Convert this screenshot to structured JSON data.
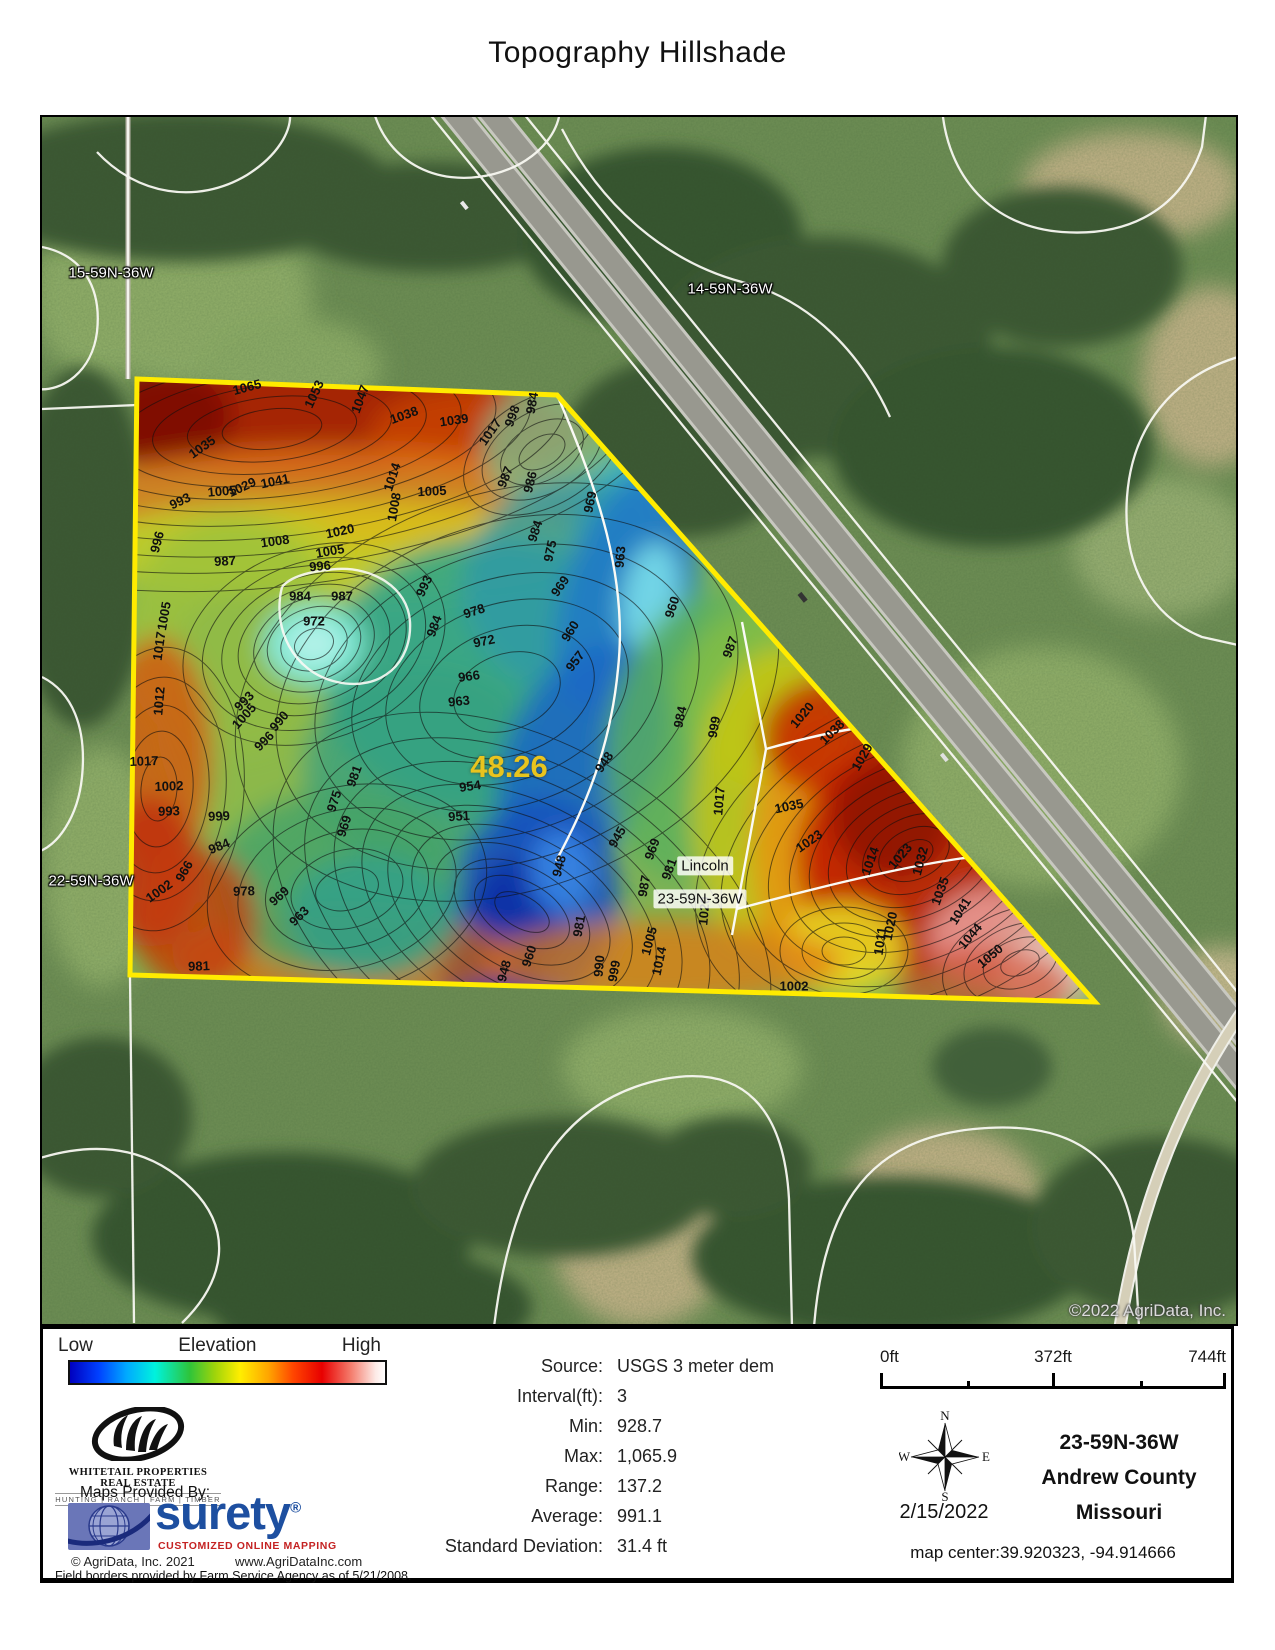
{
  "page": {
    "title": "Topography Hillshade"
  },
  "map": {
    "watermark": "©2022 AgriData, Inc.",
    "acreage_label": "48.26",
    "acreage_pos": {
      "x": 467,
      "y": 650
    },
    "parcel_labels": [
      {
        "text": "15-59N-36W",
        "x": 69,
        "y": 156,
        "variant": "light"
      },
      {
        "text": "14-59N-36W",
        "x": 688,
        "y": 172,
        "variant": "light"
      },
      {
        "text": "22-59N-36W",
        "x": 49,
        "y": 764,
        "variant": "light"
      },
      {
        "text": "Lincoln",
        "x": 663,
        "y": 749,
        "variant": "dark"
      },
      {
        "text": "23-59N-36W",
        "x": 658,
        "y": 782,
        "variant": "dark"
      }
    ],
    "contour_labels": [
      {
        "v": "1065",
        "x": 205,
        "y": 270,
        "r": -15
      },
      {
        "v": "1053",
        "x": 272,
        "y": 277,
        "r": -65
      },
      {
        "v": "1047",
        "x": 318,
        "y": 282,
        "r": -70
      },
      {
        "v": "1038",
        "x": 362,
        "y": 298,
        "r": -20
      },
      {
        "v": "1039",
        "x": 412,
        "y": 303,
        "r": -8
      },
      {
        "v": "1017",
        "x": 448,
        "y": 315,
        "r": -55
      },
      {
        "v": "998",
        "x": 470,
        "y": 299,
        "r": -70
      },
      {
        "v": "984",
        "x": 490,
        "y": 286,
        "r": -80
      },
      {
        "v": "1035",
        "x": 160,
        "y": 330,
        "r": -35
      },
      {
        "v": "1029",
        "x": 200,
        "y": 370,
        "r": -25
      },
      {
        "v": "1041",
        "x": 233,
        "y": 364,
        "r": -12
      },
      {
        "v": "1005",
        "x": 180,
        "y": 374,
        "r": -5
      },
      {
        "v": "1014",
        "x": 350,
        "y": 360,
        "r": -72
      },
      {
        "v": "1008",
        "x": 352,
        "y": 390,
        "r": -80
      },
      {
        "v": "1005",
        "x": 390,
        "y": 374,
        "r": -3
      },
      {
        "v": "987",
        "x": 463,
        "y": 360,
        "r": -68
      },
      {
        "v": "986",
        "x": 488,
        "y": 365,
        "r": -76
      },
      {
        "v": "969",
        "x": 548,
        "y": 385,
        "r": -78
      },
      {
        "v": "963",
        "x": 578,
        "y": 440,
        "r": -85
      },
      {
        "v": "993",
        "x": 138,
        "y": 384,
        "r": -25
      },
      {
        "v": "996",
        "x": 115,
        "y": 425,
        "r": -75
      },
      {
        "v": "987",
        "x": 183,
        "y": 444,
        "r": -3
      },
      {
        "v": "1020",
        "x": 298,
        "y": 414,
        "r": -12
      },
      {
        "v": "1008",
        "x": 233,
        "y": 424,
        "r": -8
      },
      {
        "v": "1005",
        "x": 288,
        "y": 434,
        "r": -10
      },
      {
        "v": "996",
        "x": 278,
        "y": 449,
        "r": -5
      },
      {
        "v": "984",
        "x": 493,
        "y": 414,
        "r": -72
      },
      {
        "v": "975",
        "x": 508,
        "y": 434,
        "r": -78
      },
      {
        "v": "969",
        "x": 518,
        "y": 469,
        "r": -55
      },
      {
        "v": "960",
        "x": 528,
        "y": 514,
        "r": -58
      },
      {
        "v": "957",
        "x": 533,
        "y": 544,
        "r": -52
      },
      {
        "v": "984",
        "x": 258,
        "y": 479,
        "r": 0
      },
      {
        "v": "987",
        "x": 300,
        "y": 479,
        "r": 0
      },
      {
        "v": "972",
        "x": 272,
        "y": 504,
        "r": 0
      },
      {
        "v": "1005",
        "x": 122,
        "y": 499,
        "r": -80
      },
      {
        "v": "1017",
        "x": 117,
        "y": 529,
        "r": -82
      },
      {
        "v": "1012",
        "x": 117,
        "y": 584,
        "r": -85
      },
      {
        "v": "978",
        "x": 432,
        "y": 494,
        "r": -18
      },
      {
        "v": "972",
        "x": 442,
        "y": 524,
        "r": -12
      },
      {
        "v": "966",
        "x": 427,
        "y": 559,
        "r": -8
      },
      {
        "v": "963",
        "x": 417,
        "y": 584,
        "r": -6
      },
      {
        "v": "984",
        "x": 392,
        "y": 509,
        "r": -70
      },
      {
        "v": "993",
        "x": 382,
        "y": 469,
        "r": -65
      },
      {
        "v": "954",
        "x": 428,
        "y": 669,
        "r": -8
      },
      {
        "v": "951",
        "x": 417,
        "y": 699,
        "r": -4
      },
      {
        "v": "948",
        "x": 517,
        "y": 749,
        "r": -75
      },
      {
        "v": "945",
        "x": 575,
        "y": 720,
        "r": -60
      },
      {
        "v": "969",
        "x": 610,
        "y": 732,
        "r": -70
      },
      {
        "v": "981",
        "x": 627,
        "y": 752,
        "r": -70
      },
      {
        "v": "1017",
        "x": 677,
        "y": 684,
        "r": -85
      },
      {
        "v": "1035",
        "x": 747,
        "y": 689,
        "r": -12
      },
      {
        "v": "1023",
        "x": 767,
        "y": 724,
        "r": -35
      },
      {
        "v": "1020",
        "x": 760,
        "y": 598,
        "r": -50
      },
      {
        "v": "1038",
        "x": 790,
        "y": 615,
        "r": -45
      },
      {
        "v": "1029",
        "x": 820,
        "y": 640,
        "r": -60
      },
      {
        "v": "987",
        "x": 688,
        "y": 530,
        "r": -70
      },
      {
        "v": "999",
        "x": 672,
        "y": 610,
        "r": -80
      },
      {
        "v": "984",
        "x": 638,
        "y": 600,
        "r": -78
      },
      {
        "v": "960",
        "x": 630,
        "y": 490,
        "r": -72
      },
      {
        "v": "948",
        "x": 562,
        "y": 645,
        "r": -55
      },
      {
        "v": "1014",
        "x": 828,
        "y": 744,
        "r": -70
      },
      {
        "v": "1023",
        "x": 858,
        "y": 739,
        "r": -50
      },
      {
        "v": "1032",
        "x": 878,
        "y": 744,
        "r": -75
      },
      {
        "v": "1035",
        "x": 898,
        "y": 774,
        "r": -70
      },
      {
        "v": "1041",
        "x": 918,
        "y": 794,
        "r": -58
      },
      {
        "v": "1044",
        "x": 928,
        "y": 819,
        "r": -50
      },
      {
        "v": "1050",
        "x": 948,
        "y": 839,
        "r": -40
      },
      {
        "v": "1020",
        "x": 848,
        "y": 809,
        "r": -78
      },
      {
        "v": "1011",
        "x": 838,
        "y": 824,
        "r": -82
      },
      {
        "v": "1002",
        "x": 752,
        "y": 869,
        "r": 0
      },
      {
        "v": "1020",
        "x": 662,
        "y": 794,
        "r": -85
      },
      {
        "v": "1005",
        "x": 607,
        "y": 824,
        "r": -75
      },
      {
        "v": "1014",
        "x": 617,
        "y": 844,
        "r": -78
      },
      {
        "v": "999",
        "x": 572,
        "y": 854,
        "r": -80
      },
      {
        "v": "990",
        "x": 557,
        "y": 849,
        "r": -85
      },
      {
        "v": "987",
        "x": 602,
        "y": 769,
        "r": -80
      },
      {
        "v": "981",
        "x": 537,
        "y": 809,
        "r": -80
      },
      {
        "v": "960",
        "x": 487,
        "y": 839,
        "r": -72
      },
      {
        "v": "948",
        "x": 462,
        "y": 854,
        "r": -75
      },
      {
        "v": "978",
        "x": 202,
        "y": 774,
        "r": -2
      },
      {
        "v": "969",
        "x": 237,
        "y": 779,
        "r": -42
      },
      {
        "v": "963",
        "x": 257,
        "y": 799,
        "r": -45
      },
      {
        "v": "984",
        "x": 177,
        "y": 729,
        "r": -22
      },
      {
        "v": "999",
        "x": 177,
        "y": 699,
        "r": -2
      },
      {
        "v": "993",
        "x": 127,
        "y": 694,
        "r": -2
      },
      {
        "v": "1002",
        "x": 127,
        "y": 669,
        "r": -2
      },
      {
        "v": "1017",
        "x": 102,
        "y": 644,
        "r": -2
      },
      {
        "v": "966",
        "x": 142,
        "y": 754,
        "r": -60
      },
      {
        "v": "1002",
        "x": 117,
        "y": 774,
        "r": -35
      },
      {
        "v": "981",
        "x": 157,
        "y": 849,
        "r": -2
      },
      {
        "v": "993",
        "x": 202,
        "y": 584,
        "r": -45
      },
      {
        "v": "990",
        "x": 237,
        "y": 604,
        "r": -50
      },
      {
        "v": "996",
        "x": 222,
        "y": 624,
        "r": -45
      },
      {
        "v": "1005",
        "x": 202,
        "y": 599,
        "r": -48
      },
      {
        "v": "981",
        "x": 312,
        "y": 659,
        "r": -70
      },
      {
        "v": "975",
        "x": 292,
        "y": 684,
        "r": -72
      },
      {
        "v": "969",
        "x": 302,
        "y": 709,
        "r": -72
      }
    ],
    "colors": {
      "parcel_outline": "#ffeb00",
      "acreage_text": "#e9c41e"
    }
  },
  "legend": {
    "low": "Low",
    "title": "Elevation",
    "high": "High",
    "gradient_stops": [
      {
        "color": "#0000bf",
        "pos": "0%"
      },
      {
        "color": "#0040ff",
        "pos": "9%"
      },
      {
        "color": "#00aaff",
        "pos": "18%"
      },
      {
        "color": "#00f2dd",
        "pos": "27%"
      },
      {
        "color": "#2ec43a",
        "pos": "38%"
      },
      {
        "color": "#9fd40a",
        "pos": "46%"
      },
      {
        "color": "#ffee00",
        "pos": "54%"
      },
      {
        "color": "#ffa500",
        "pos": "63%"
      },
      {
        "color": "#ff4400",
        "pos": "71%"
      },
      {
        "color": "#e80000",
        "pos": "80%"
      },
      {
        "color": "#f47a6a",
        "pos": "89%"
      },
      {
        "color": "#fdeae6",
        "pos": "97%"
      },
      {
        "color": "#ffffff",
        "pos": "100%"
      }
    ]
  },
  "stats": {
    "rows": [
      {
        "label": "Source:",
        "value": "USGS 3 meter dem"
      },
      {
        "label": "Interval(ft):",
        "value": "3"
      },
      {
        "label": "Min:",
        "value": "928.7"
      },
      {
        "label": "Max:",
        "value": "1,065.9"
      },
      {
        "label": "Range:",
        "value": "137.2"
      },
      {
        "label": "Average:",
        "value": "991.1"
      },
      {
        "label": "Standard Deviation:",
        "value": "31.4 ft"
      }
    ]
  },
  "scalebar": {
    "ticks": [
      "0ft",
      "372ft",
      "744ft"
    ]
  },
  "compass": {
    "n": "N",
    "e": "E",
    "s": "S",
    "w": "W",
    "date": "2/15/2022"
  },
  "location": {
    "line1": "23-59N-36W",
    "line2": "Andrew County",
    "line3": "Missouri",
    "map_center": "map center:39.920323, -94.914666"
  },
  "branding": {
    "whitetail_name": "WHITETAIL PROPERTIES REAL ESTATE",
    "whitetail_tagline": "HUNTING | RANCH | FARM | TIMBER",
    "maps_provided": "Maps Provided By:",
    "surety": "surety",
    "surety_reg": "®",
    "surety_tagline": "CUSTOMIZED ONLINE MAPPING",
    "agridata_copyright": "© AgriData, Inc. 2021",
    "agridata_url": "www.AgriDataInc.com",
    "field_borders": "Field borders provided by Farm Service Agency as of 5/21/2008."
  }
}
